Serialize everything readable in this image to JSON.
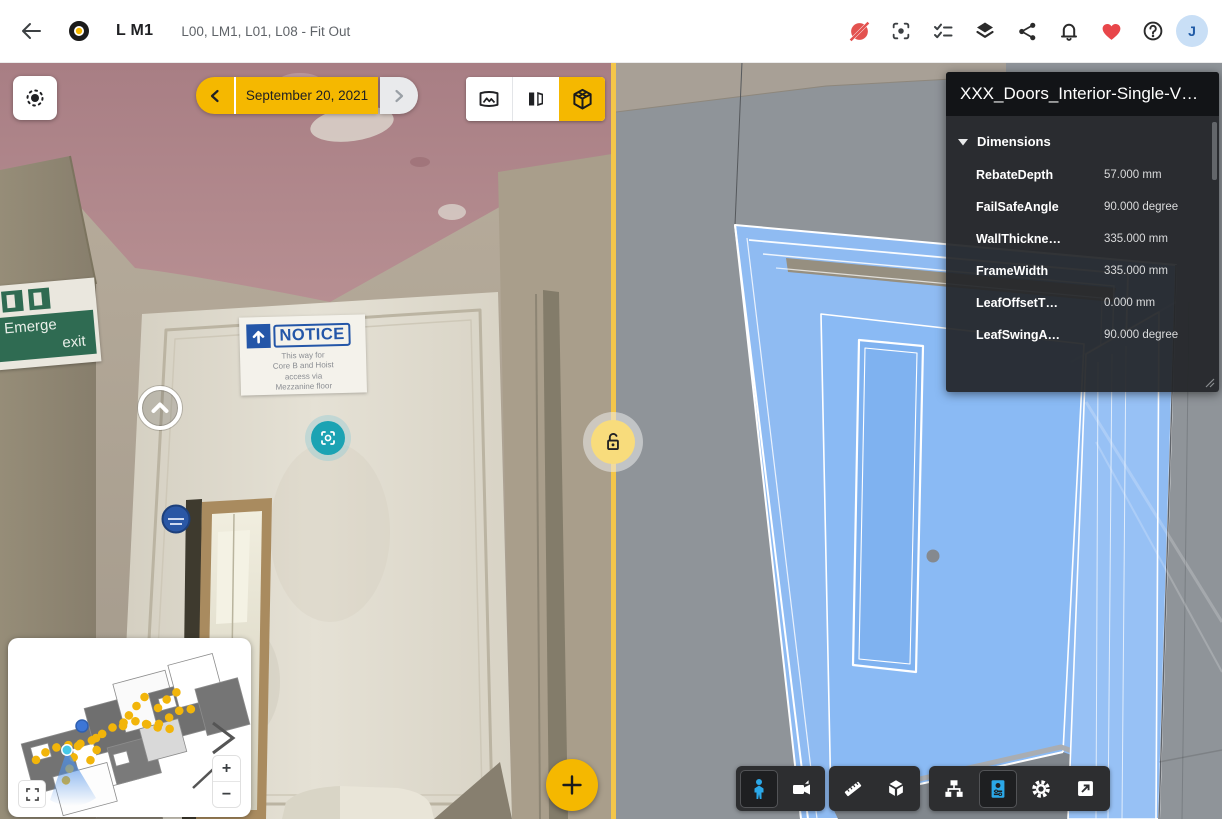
{
  "topbar": {
    "title": "L M1",
    "breadcrumb": "L00, LM1, L01, L08 - Fit Out",
    "avatar_initial": "J"
  },
  "left_pane": {
    "date_nav": {
      "date": "September 20, 2021"
    },
    "notice_sign": {
      "title": "NOTICE",
      "lines": [
        "This way for",
        "Core B and Hoist",
        "access via",
        "Mezzanine floor"
      ]
    },
    "emergency_sign": {
      "line1": "Emerge",
      "line2": "exit"
    },
    "minimap": {
      "zoom_in": "+",
      "zoom_out": "−"
    }
  },
  "right_pane": {
    "properties_panel": {
      "title": "XXX_Doors_Interior-Single-V…",
      "section": "Dimensions",
      "rows": [
        {
          "label": "RebateDepth",
          "value": "57.000 mm"
        },
        {
          "label": "FailSafeAngle",
          "value": "90.000 degree"
        },
        {
          "label": "WallThickne…",
          "value": "335.000 mm"
        },
        {
          "label": "FrameWidth",
          "value": "335.000 mm"
        },
        {
          "label": "LeafOffsetT…",
          "value": "0.000 mm"
        },
        {
          "label": "LeafSwingA…",
          "value": "90.000 degree"
        }
      ]
    }
  },
  "colors": {
    "brand_yellow": "#F5B800",
    "divider_yellow": "#F4C64A",
    "teal": "#1BA3B3",
    "active_blue": "#2BA8E8",
    "selection_blue": "#8ABAF4",
    "heart_red": "#E8464A",
    "alert_red": "#E3524F"
  }
}
